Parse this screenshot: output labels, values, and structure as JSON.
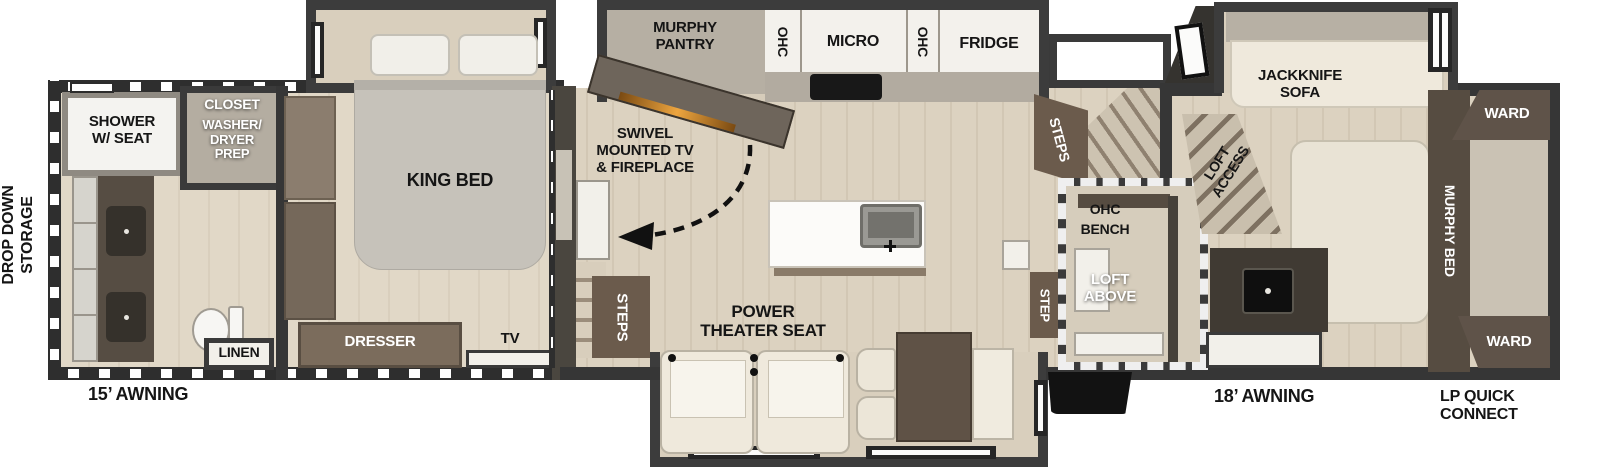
{
  "plan": {
    "exterior_labels": {
      "drop_down_storage": "DROP DOWN\nSTORAGE",
      "awning_rear": "15’ AWNING",
      "awning_front": "18’ AWNING",
      "lp_quick_connect": "LP QUICK\nCONNECT"
    },
    "bathroom": {
      "shower": "SHOWER\nW/ SEAT",
      "closet": "CLOSET",
      "washer_dryer_prep": "WASHER/\nDRYER\nPREP",
      "linen": "LINEN"
    },
    "bedroom": {
      "king_bed": "KING BED",
      "dresser": "DRESSER",
      "tv": "TV"
    },
    "kitchen": {
      "murphy_pantry": "MURPHY\nPANTRY",
      "swivel_tv": "SWIVEL\nMOUNTED TV\n& FIREPLACE",
      "ohc_left": "OHC",
      "micro": "MICRO",
      "ohc_right": "OHC",
      "fridge": "FRIDGE",
      "steps_to_bedroom": "STEPS"
    },
    "living": {
      "power_theater_seat": "POWER\nTHEATER SEAT",
      "steps_to_front": "STEPS",
      "step": "STEP",
      "ohc": "OHC",
      "bench": "BENCH",
      "loft_above": "LOFT\nABOVE",
      "loft_access": "LOFT\nACCESS"
    },
    "front_room": {
      "jackknife_sofa": "JACKKNIFE\nSOFA",
      "ward_top": "WARD",
      "murphy_bed": "MURPHY BED",
      "ward_bottom": "WARD"
    },
    "colors": {
      "wall": "#363636",
      "floor_main": "#dcd2c0",
      "floor_rear": "#e1d8c7",
      "cabinet_brown": "#6b5b4c",
      "dark_brown": "#564c41",
      "fireplace_glow": "#e8a23c",
      "fixture_white": "#f2f0ea",
      "counter_gray": "#b2aba0",
      "bed_gray": "#c6c2ba",
      "seat_cream": "#efe9dc"
    }
  }
}
